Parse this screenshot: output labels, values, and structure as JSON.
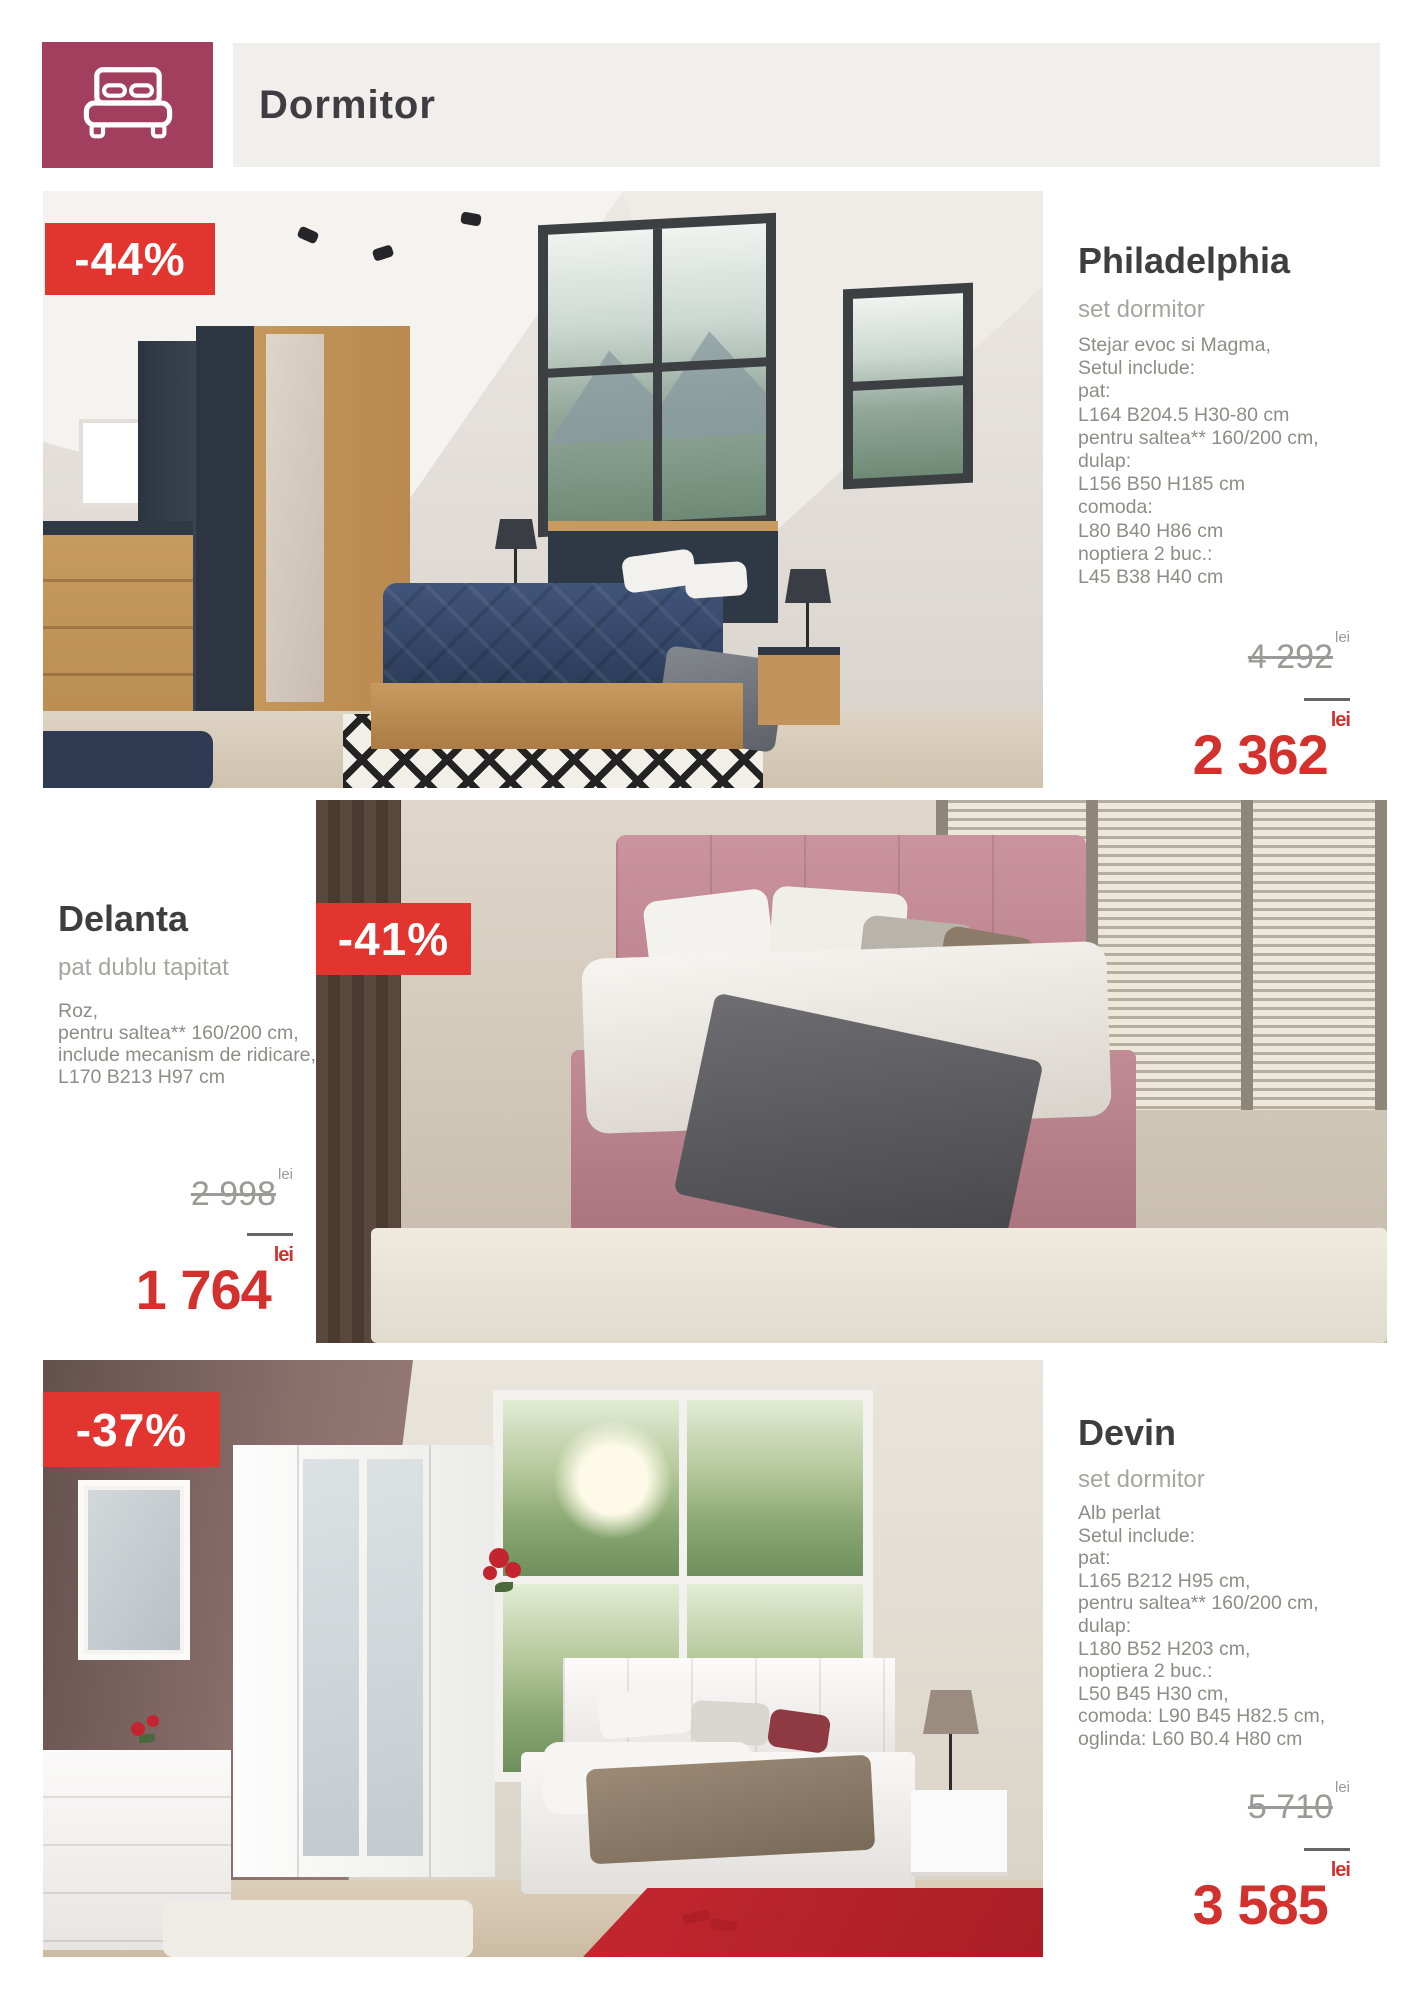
{
  "header": {
    "title": "Dormitor",
    "icon": "bed-icon"
  },
  "currency": "lei",
  "colors": {
    "brand_maroon": "#a23f5f",
    "badge_red": "#e23530",
    "price_red": "#d2312d",
    "header_bar_gray": "#f1efec",
    "text_dark": "#3e3e41",
    "text_gray": "#8e8c8a"
  },
  "products": [
    {
      "name": "Philadelphia",
      "category": "set dormitor",
      "discount": "-44%",
      "description_lines": [
        "Stejar evoc si Magma,",
        "Setul include:",
        "pat:",
        "L164 B204.5 H30-80 cm",
        "pentru saltea** 160/200 cm,",
        "dulap:",
        "L156 B50 H185 cm",
        "comoda:",
        "L80 B40 H86 cm",
        "noptiera 2 buc.:",
        "L45 B38 H40 cm"
      ],
      "old_price": "4 292",
      "new_price": "2 362",
      "currency": "lei"
    },
    {
      "name": "Delanta",
      "category": "pat dublu tapitat",
      "discount": "-41%",
      "description_lines": [
        "Roz,",
        "pentru saltea** 160/200 cm,",
        "include mecanism de ridicare,",
        "L170 B213 H97 cm"
      ],
      "old_price": "2 998",
      "new_price": "1 764",
      "currency": "lei"
    },
    {
      "name": "Devin",
      "category": "set dormitor",
      "discount": "-37%",
      "description_lines": [
        "Alb perlat",
        "Setul include:",
        "pat:",
        "L165 B212 H95 cm,",
        "pentru saltea** 160/200 cm,",
        "dulap:",
        "L180 B52 H203 cm,",
        "noptiera 2 buc.:",
        "L50 B45 H30 cm,",
        "comoda: L90 B45 H82.5 cm,",
        "oglinda: L60 B0.4 H80 cm"
      ],
      "old_price": "5 710",
      "new_price": "3 585",
      "currency": "lei"
    }
  ]
}
